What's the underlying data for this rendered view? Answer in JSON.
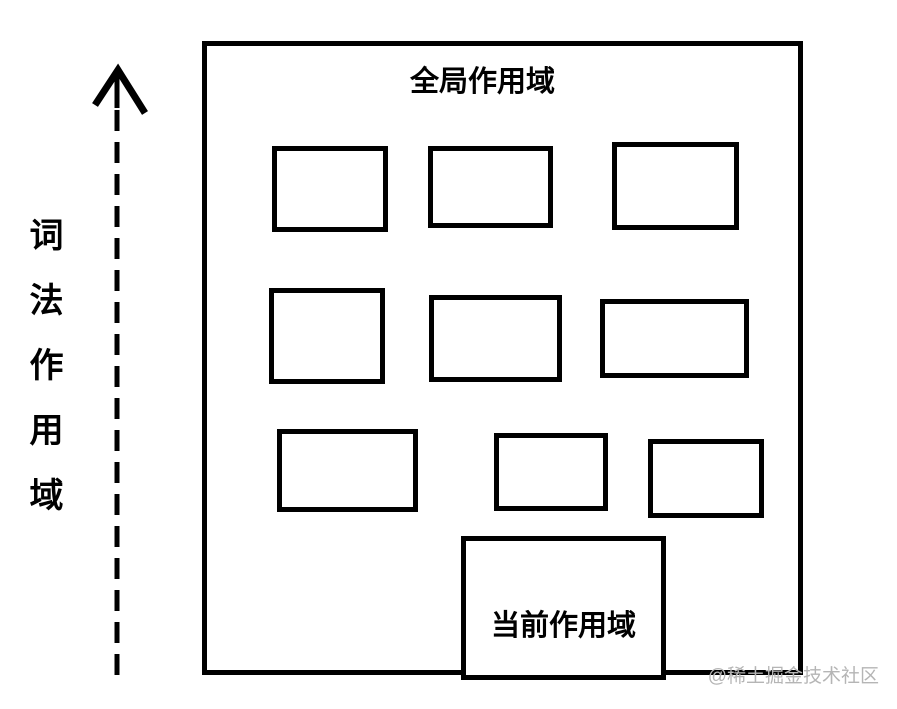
{
  "diagram": {
    "title": "全局作用域",
    "current_scope_label": "当前作用域",
    "axis_label": "词法作用域",
    "watermark": "@稀土掘金技术社区",
    "unlabeled_box_rows": [
      3,
      3,
      3
    ],
    "colors": {
      "line": "#000000",
      "background": "#ffffff",
      "watermark": "#b5b5b5"
    }
  }
}
